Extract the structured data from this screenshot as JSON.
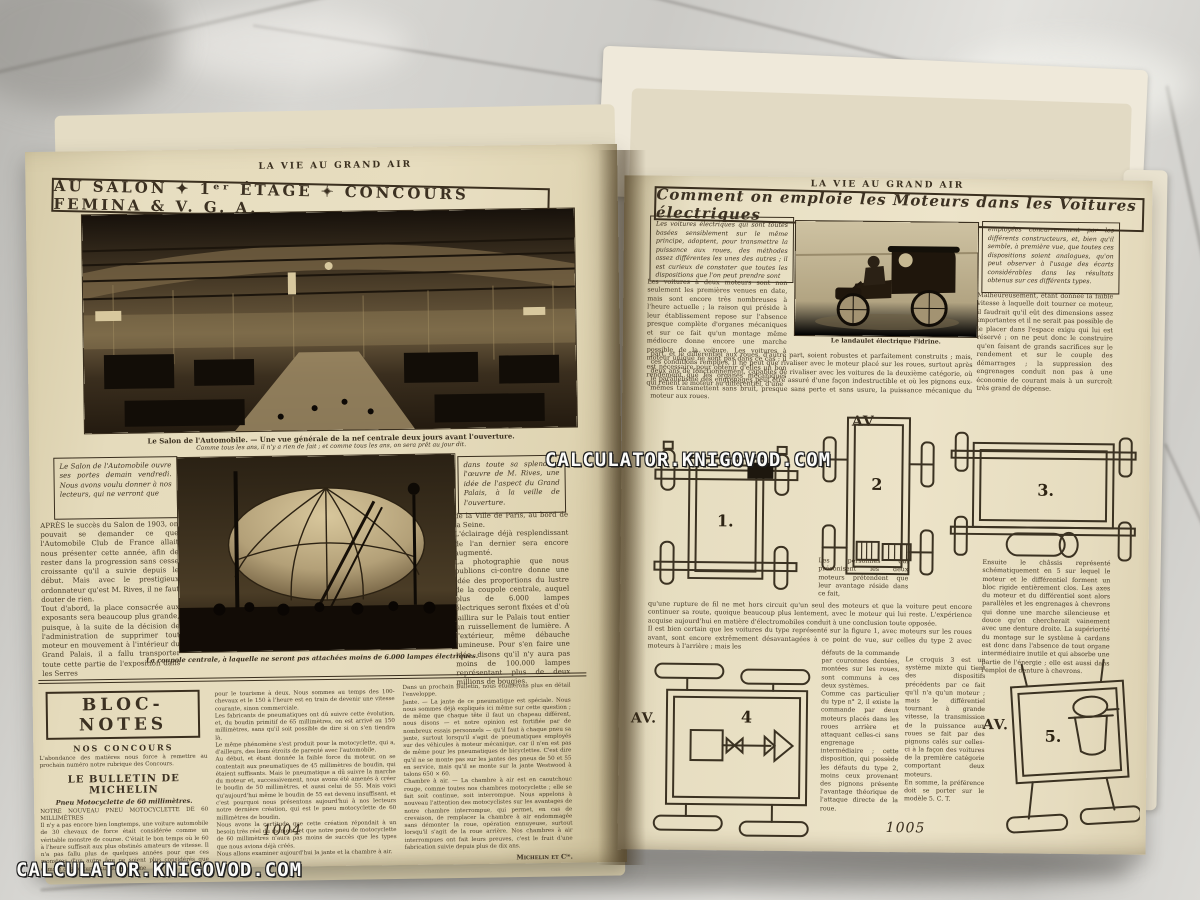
{
  "watermark": {
    "text": "CALCULATOR.KNIGOVOD.COM"
  },
  "left_page": {
    "masthead": "LA VIE AU GRAND AIR",
    "title": "AU SALON ✦ 1ᵉʳ ÉTAGE ✦ CONCOURS FEMINA & V. G. A.",
    "photo1_caption_line1": "Le Salon de l'Automobile. — Une vue générale de la nef centrale deux jours avant l'ouverture.",
    "photo1_caption_line2": "Comme tous les ans, il n'y a rien de fait ; et comme tous les ans, on sera prêt au jour dit.",
    "intro_box_left": "Le Salon de l'Automobile ouvre ses portes demain vendredi. Nous avons voulu donner à nos lecteurs, qui ne verront que",
    "para_apres": "APRÈS le succès du Salon de 1903, on pouvait se demander ce que l'Automobile Club de France allait nous présenter cette année, afin de rester dans la progression sans cesse croissante qu'il a suivie depuis le début. Mais avec le prestigieux ordonnateur qu'est M. Rives, il ne faut douter de rien.\nTout d'abord, la place consacrée aux exposants sera beaucoup plus grande, puisque, à la suite de la décision de l'administration de supprimer tout moteur en mouvement à l'intérieur du Grand Palais, il a fallu transporter toute cette partie de l'exposition dans les Serres",
    "intro_box_right": "dans toute sa splendeur l'œuvre de M. Rives, une idée de l'aspect du Grand Palais, à la veille de l'ouverture.",
    "para_ville": "de la Ville de Paris, au bord de la Seine.\nL'éclairage déjà resplendissant de l'an dernier sera encore augmenté.\nLa photographie que nous publions ci-contre donne une idée des proportions du lustre de la coupole centrale, auquel plus de 6.000 lampes électriques seront fixées et d'où jaillira sur le Palais tout entier un ruissellement de lumière. A l'extérieur, même débauche lumineuse. Pour s'en faire une idée, disons qu'il n'y aura pas moins de 100.000 lampes représentant plus de deux millions de bougies.",
    "photo2_caption": "La coupole centrale, à laquelle ne seront pas attachées moins de 6.000 lampes électriques.",
    "bloc_notes": {
      "title": "BLOC-NOTES",
      "subtitle": "NOS CONCOURS",
      "concours_text": "L'abondance des matières nous force à remettre au prochain numéro notre rubrique des Concours.",
      "bulletin_title": "LE BULLETIN DE MICHELIN",
      "bulletin_subtitle": "Pneu Motocyclette de 60 millimètres.",
      "col1_text": "NOTRE NOUVEAU PNEU MOTOCYCLETTE DE 60 MILLIMÈTRES\nIl n'y a pas encore bien longtemps, une voiture automobile de 30 chevaux de force était considérée comme un véritable monstre de course. C'était le bon temps où le 60 à l'heure suffisait aux plus obstinés amateurs de vitesse. Il n'a pas fallu plus de quelques années pour que ces monstres d'un autre âge ne soient plus considérés que comme des voitures suffisant à peine",
      "col2_text": "pour le tourisme à deux. Nous sommes au temps des 100-chevaux et le 150 à l'heure est en train de devenir une vitesse courante, sinon commerciale.\nLes fabricants de pneumatiques ont dû suivre cette évolution, et, du boudin primitif de 65 millimètres, on est arrivé au 150 millimètres, sans qu'il soit possible de dire si on s'en tiendra là.\nLe même phénomène s'est produit pour la motocyclette, qui a, d'ailleurs, des liens étroits de parenté avec l'automobile.\nAu début, et étant donnée la faible force du moteur, on se contentait aux pneumatiques de 45 millimètres de boudin, qui étaient suffisants. Mais le pneumatique a dû suivre la marche du moteur et, successivement, nous avons été amenés à créer le boudin de 50 millimètres, et aussi celui de 55. Mais voici qu'aujourd'hui même le boudin de 55 est devenu insuffisant, et c'est pourquoi nous présentons aujourd'hui à nos lecteurs notre dernière création, qui est le pneu motocyclette de 60 millimètres de boudin.\nNous avons la certitude que cette création répondait à un besoin très réel du moment, et que notre pneu de motocyclette de 60 millimètres n'aura pas moins de succès que les types que nous avions déjà créés.\nNous allons examiner aujourd'hui la jante et la chambre à air.",
      "col3_text": "Dans un prochain Bulletin, nous étudierons plus en détail l'enveloppe.\nJante. — La jante de ce pneumatique est spéciale. Nous nous sommes déjà expliqués ici même sur cette question ; de même que chaque tête il faut un chapeau différent, nous disons — et notre opinion est fortifiée par de nombreux essais personnels — qu'il faut à chaque pneu sa jante, surtout lorsqu'il s'agit de pneumatiques employés sur des véhicules à moteur mécanique, car il n'en est pas de même pour les pneumatiques de bicyclettes. C'est dire qu'il ne se monte pas sur les jantes des pneus de 50 et 55 en service, mais qu'il se monte sur la jante Westwood à talons 650 × 60.\nChambre à air. — La chambre à air est en caoutchouc rouge, comme toutes nos chambres motocyclette ; elle se fait soit continue, soit interrompue. Nous appelons à nouveau l'attention des motocyclistes sur les avantages de notre chambre interrompue, qui permet, en cas de crevaison, de remplacer la chambre à air endommagée sans démonter la roue, opération ennuyeuse, surtout lorsqu'il s'agit de la roue arrière. Nos chambres à air interrompues ont fait leurs preuves, c'est le fruit d'une fabrication suivie depuis plus de dix ans.",
      "signature": "Michelin et Cⁱᵉ."
    },
    "page_number": "1004"
  },
  "right_page": {
    "masthead": "LA VIE AU GRAND AIR",
    "title": "Comment on emploie les Moteurs dans les Voitures électriques",
    "intro_box_left": "Les voitures électriques qui sont toutes basées sensiblement sur le même principe, adoptent, pour transmettre la puissance aux roues, des méthodes assez différentes les unes des autres ; il est curieux de constater que toutes les dispositions que l'on peut prendre sont",
    "para_deux_moteurs": "Les voitures à deux moteurs sont non seulement les premières venues en date, mais sont encore très nombreuses à l'heure actuelle ; la raison qui préside à leur établissement repose sur l'absence presque complète d'organes mécaniques et sur ce fait qu'un montage même médiocre donne encore une marche possible de la voiture. Les voitures à moteur unique ne sont pas dans ce cas ; il est nécessaire pour obtenir d'elles un bon rendement que les organes mécaniques qui relient le moteur au différentiel, d'une",
    "intro_box_right": "employées concurremment par les différents constructeurs, et, bien qu'il semble, à première vue, que toutes ces dispositions soient analogues, qu'on peut observer à l'usage des écarts considérables dans les résultats obtenus sur ces différents types.",
    "para_malheureusement": "Malheureusement, étant donnée la faible vitesse à laquelle doit tourner ce moteur, il faudrait qu'il eût des dimensions assez importantes et il ne serait pas possible de le placer dans l'espace exigu qui lui est réservé ; on ne peut donc le construire qu'en faisant de grands sacrifices sur le rendement et sur le couple des démarrages ; la suppression des engrenages conduit non pas à une économie de courant mais à un surcroît très grand de dépense.",
    "photo_caption": "Le landaulet électrique Fidrine.",
    "para_differentiel": "part, et le différentiel aux roues, d'autre part, soient robustes et parfaitement construits ; mais, ces conditions remplies, il ne peut que rivaliser avec le moteur placé sur les roues, surtout après deux ans de fonctionnement, capables de rivaliser avec les voitures de la deuxième catégorie, où le parallélisme des engrenages peut être assuré d'une façon indestructible et où les pignons eux-mêmes transmettent sans bruit, presque sans perte et sans usure, la puissance mécanique du moteur aux roues.",
    "label_av_top": "AV",
    "fig1_label": "1.",
    "fig2_label": "2",
    "fig3_label": "3.",
    "para_personnes": "Les personnes qui préconisent les deux moteurs prétendent que leur avantage réside dans ce fait,",
    "para_ensuite": "Ensuite le châssis représenté schématiquement en 5 sur lequel le moteur et le différentiel forment un bloc rigide entièrement clos. Les axes du moteur et du différentiel sont alors parallèles et les engrenages à chevrons qui donne une marche silencieuse et douce qu'on chercherait vainement avec une denture droite. La supériorité du montage sur le système à cardans est donc dans l'absence de tout organe intermédiaire inutile et qui absorbe une partie de l'énergie ; elle est aussi dans l'emploi de denture à chevrons.",
    "para_rupture": "qu'une rupture de fil ne met hors circuit qu'un seul des moteurs et que la voiture peut encore continuer sa route, quoique beaucoup plus lentement, avec le moteur qui lui reste. L'expérience acquise aujourd'hui en matière d'électromobiles conduit à une conclusion toute opposée.\nIl est bien certain que les voitures du type représenté sur la figure 1, avec moteurs sur les roues avant, sont encore extrêmement désavantagées à ce point de vue, sur celles du type 2 avec moteurs à l'arrière ; mais les",
    "label_av_left": "AV.",
    "fig4_label": "4",
    "col_defauts": "défauts de la commande par couronnes dentées, montées sur les roues, sont communs à ces deux systèmes.\nComme cas particulier du type n° 2, il existe la commande par deux moteurs placés dans les roues arrière et attaquant celles-ci sans engrenage intermédiaire ; cette disposition, qui possède les défauts du type 2, moins ceux provenant des pignons présente l'avantage théorique de l'attaque directe de la roue.",
    "col_mixte": "Le croquis 3 est un système mixte qui tient des dispositifs précédents par ce fait qu'il n'a qu'un moteur ; mais le différentiel tournant à grande vitesse, la transmission de la puissance aux roues se fait par des pignons calés sur celles-ci à la façon des voitures de la première catégorie comportant deux moteurs.\nEn somme, la préférence doit se porter sur le modèle 5.  C. T.",
    "label_av_right": "AV.",
    "fig5_label": "5.",
    "page_number": "1005"
  }
}
